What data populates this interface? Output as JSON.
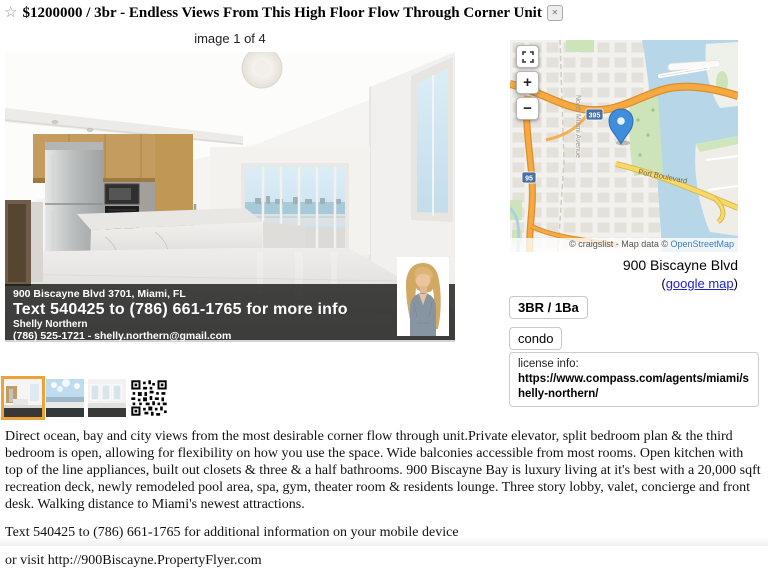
{
  "header": {
    "star": "☆",
    "title": "$1200000 / 3br - Endless Views From This High Floor Flow Through Corner Unit",
    "banish_glyph": "✕"
  },
  "gallery": {
    "caption": "image 1 of 4",
    "overlay": {
      "address": "900 Biscayne Blvd 3701, Miami, FL",
      "cta": "Text 540425 to (786) 661-1765 for more info",
      "agent_name": "Shelly Northern",
      "agent_contact": "(786) 525-1721 - shelly.northern@gmail.com"
    }
  },
  "map": {
    "zoom_in_label": "+",
    "zoom_out_label": "−",
    "shield_i395": "395",
    "shield_i95": "95",
    "street_label": "North Miami Avenue",
    "road_label": "Port Boulevard",
    "attribution_prefix": "© craigslist - Map data © ",
    "attribution_link": "OpenStreetMap"
  },
  "sidebar": {
    "address": "900 Biscayne Blvd",
    "map_link_open": "(",
    "map_link_text": "google map",
    "map_link_close": ")",
    "bed_bath": "3BR / 1Ba",
    "housing_type": "condo",
    "license_label": "license info:",
    "license_url": "https://www.compass.com/agents/miami/shelly-northern/"
  },
  "posting": {
    "description": "Direct ocean, bay and city views from the most desirable corner flow through unit.Private elevator, split bedroom plan & the third bedroom is open, allowing for flexibility on how you use the space. Wide balconies accessible from most rooms. Open kitchen with top of the line appliances, built out closets & three & a half bathrooms. 900 Biscayne Bay is luxury living at it's best with a 20,000 sqft recreation deck, newly remodeled pool area, spa, gym, theater room & residents lounge. Three story lobby, valet, concierge and front desk. Walking distance to Miami's newest attractions.",
    "sms_line": "Text 540425 to (786) 661-1765 for additional information on your mobile device",
    "visit_line": "or visit http://900Biscayne.PropertyFlyer.com"
  },
  "colors": {
    "selected_thumb_border": "#f0a236",
    "link_blue": "#2222cc",
    "osm_link_blue": "#3b7bbf",
    "map_pin_blue": "#3f8ddb",
    "motorway_orange": "#f5a940",
    "road_yellow": "#f7d96a",
    "water_blue": "#b7d7e8"
  }
}
